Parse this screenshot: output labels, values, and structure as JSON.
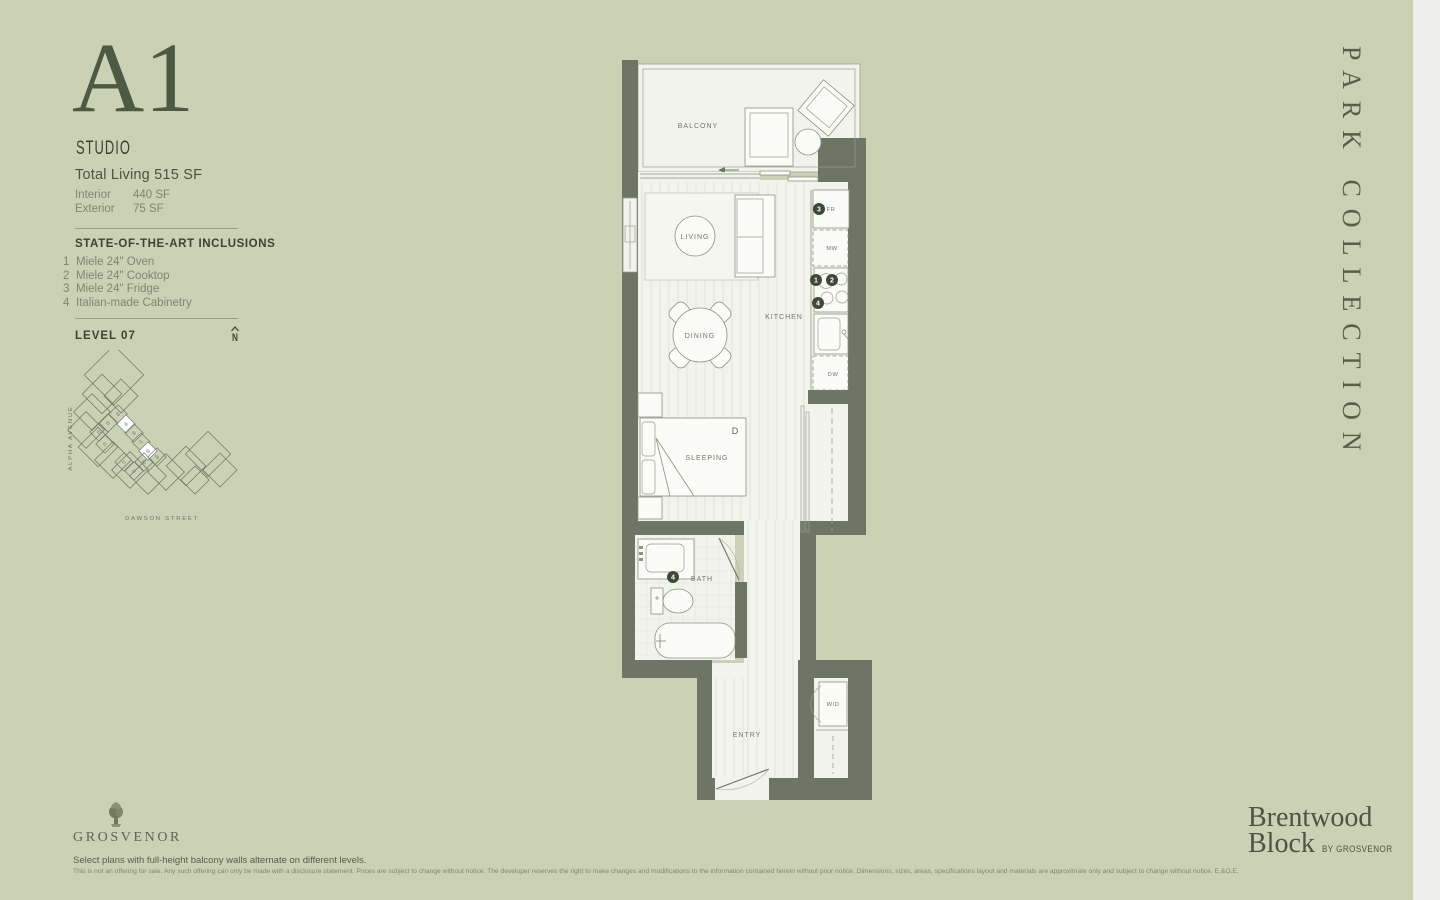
{
  "colors": {
    "background": "#cad1b4",
    "edge_strip": "#eeeeec",
    "wall": "#6f7565",
    "floor": "#f2f3ec",
    "ink_dark": "#3a4530",
    "ink_mid": "#55604a",
    "ink_light": "#7e8672",
    "marker": "#3f4937"
  },
  "plan_header": {
    "unit": "A1",
    "type": "STUDIO",
    "total": "Total Living 515 SF",
    "interior_label": "Interior",
    "interior_value": "440 SF",
    "exterior_label": "Exterior",
    "exterior_value": "75 SF"
  },
  "inclusions": {
    "title": "STATE-OF-THE-ART INCLUSIONS",
    "items": [
      {
        "num": "1",
        "text": "Miele 24\" Oven"
      },
      {
        "num": "2",
        "text": "Miele 24\" Cooktop"
      },
      {
        "num": "3",
        "text": "Miele 24\" Fridge"
      },
      {
        "num": "4",
        "text": "Italian-made Cabinetry"
      }
    ]
  },
  "level": {
    "label": "LEVEL 07",
    "north": "N"
  },
  "keyplan": {
    "street_left": "ALPHA AVENUE",
    "street_bottom": "DAWSON STREET",
    "blocks": [
      {
        "x": 56,
        "y": 25,
        "s": 21
      },
      {
        "x": 44,
        "y": 44,
        "s": 14
      },
      {
        "x": 63,
        "y": 46,
        "s": 12
      },
      {
        "x": 34,
        "y": 62,
        "s": 13
      },
      {
        "x": 28,
        "y": 80,
        "s": 13
      },
      {
        "x": 40,
        "y": 97,
        "s": 14
      },
      {
        "x": 55,
        "y": 110,
        "s": 13
      },
      {
        "x": 72,
        "y": 120,
        "s": 13
      },
      {
        "x": 90,
        "y": 126,
        "s": 13
      },
      {
        "x": 108,
        "y": 122,
        "s": 13
      },
      {
        "x": 128,
        "y": 116,
        "s": 14
      },
      {
        "x": 150,
        "y": 104,
        "s": 16
      },
      {
        "x": 162,
        "y": 120,
        "s": 12
      },
      {
        "x": 137,
        "y": 130,
        "s": 10
      }
    ],
    "units": [
      {
        "n": "04",
        "x": 60,
        "y": 64
      },
      {
        "n": "05",
        "x": 68,
        "y": 74,
        "hl": true
      },
      {
        "n": "06",
        "x": 76,
        "y": 83
      },
      {
        "n": "07",
        "x": 83,
        "y": 92
      },
      {
        "n": "08",
        "x": 90,
        "y": 101,
        "hl": true
      },
      {
        "n": "09",
        "x": 99,
        "y": 107
      },
      {
        "n": "03",
        "x": 50,
        "y": 73
      },
      {
        "n": "02",
        "x": 41,
        "y": 82
      },
      {
        "n": "01",
        "x": 47,
        "y": 94
      },
      {
        "n": "12",
        "x": 66,
        "y": 112
      },
      {
        "n": "11",
        "x": 76,
        "y": 121
      },
      {
        "n": "10",
        "x": 86,
        "y": 112
      }
    ]
  },
  "floorplan": {
    "rooms": {
      "balcony": "BALCONY",
      "living": "LIVING",
      "dining": "DINING",
      "kitchen": "KITCHEN",
      "sleeping": "SLEEPING",
      "bath": "BATH",
      "entry": "ENTRY"
    },
    "fixtures": {
      "fridge": "FR",
      "microwave": "MW",
      "dishwasher": "DW",
      "washer_dryer": "W/D",
      "bed_size": "D"
    },
    "markers": {
      "oven": "1",
      "cooktop": "2",
      "fridge": "3",
      "cabinetry_kitchen": "4",
      "cabinetry_bath": "4"
    }
  },
  "collection": "PARK COLLECTION",
  "brand": {
    "name_line1": "Brentwood",
    "name_line2": "Block",
    "byline": "BY GROSVENOR"
  },
  "developer": {
    "wordmark": "GROSVENOR"
  },
  "footnotes": {
    "note": "Select plans with full-height balcony walls alternate on different levels.",
    "legal": "This is not an offering for sale. Any such offering can only be made with a disclosure statement. Prices are subject to change without notice. The developer reserves the right to make changes and modifications to the information contained herein without prior notice. Dimensions, sizes, areas, specifications layout and materials are approximate only and subject to change without notice.  E.&O.E."
  }
}
